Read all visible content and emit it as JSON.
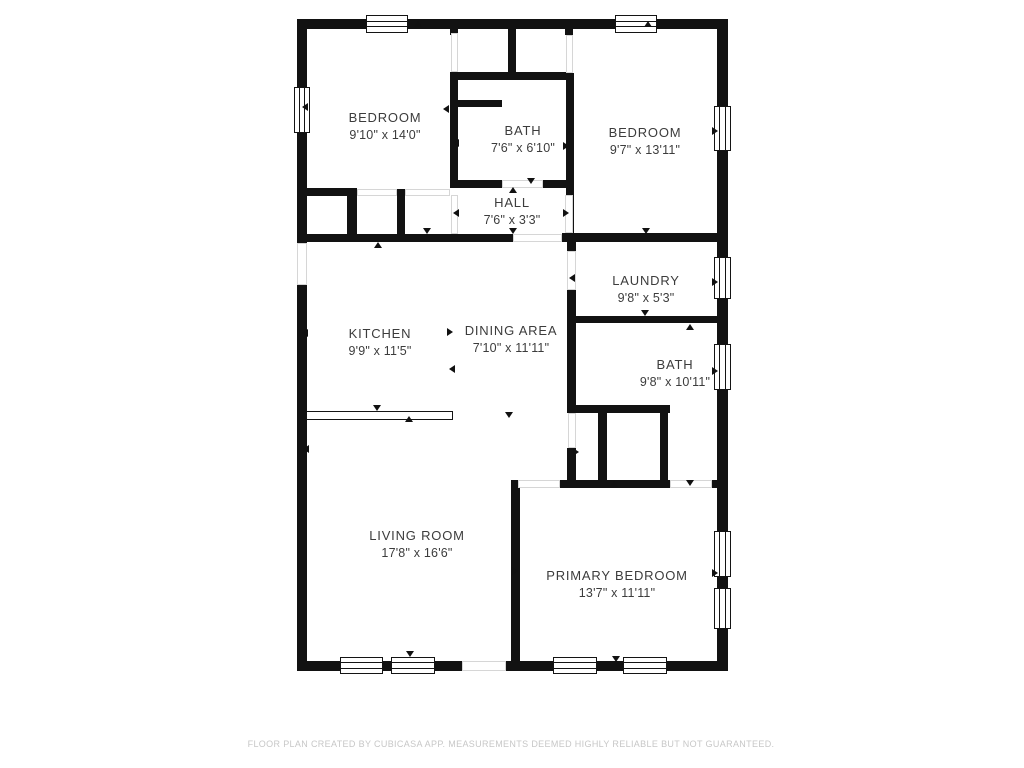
{
  "meta": {
    "type": "floor-plan",
    "background_color": "#ffffff",
    "wall_color": "#121212",
    "label_color": "#3c3c3c",
    "footer_color": "#c7c7c7"
  },
  "rooms": [
    {
      "name": "BEDROOM",
      "dims": "9'10\" x 14'0\"",
      "cx": 385,
      "cy": 126
    },
    {
      "name": "BATH",
      "dims": "7'6\" x 6'10\"",
      "cx": 523,
      "cy": 139
    },
    {
      "name": "BEDROOM",
      "dims": "9'7\" x 13'11\"",
      "cx": 645,
      "cy": 141
    },
    {
      "name": "HALL",
      "dims": "7'6\" x 3'3\"",
      "cx": 512,
      "cy": 211
    },
    {
      "name": "LAUNDRY",
      "dims": "9'8\" x 5'3\"",
      "cx": 646,
      "cy": 289
    },
    {
      "name": "KITCHEN",
      "dims": "9'9\" x 11'5\"",
      "cx": 380,
      "cy": 342
    },
    {
      "name": "DINING AREA",
      "dims": "7'10\" x 11'11\"",
      "cx": 511,
      "cy": 339
    },
    {
      "name": "BATH",
      "dims": "9'8\" x 10'11\"",
      "cx": 675,
      "cy": 373
    },
    {
      "name": "LIVING ROOM",
      "dims": "17'8\" x 16'6\"",
      "cx": 417,
      "cy": 544
    },
    {
      "name": "PRIMARY BEDROOM",
      "dims": "13'7\" x 11'11\"",
      "cx": 617,
      "cy": 584
    }
  ],
  "geometry": {
    "walls": [
      [
        297,
        19,
        431,
        10
      ],
      [
        297,
        19,
        10,
        652
      ],
      [
        717,
        19,
        11,
        652
      ],
      [
        297,
        661,
        431,
        10
      ],
      [
        450,
        28,
        8,
        7
      ],
      [
        508,
        28,
        8,
        44
      ],
      [
        565,
        28,
        8,
        7
      ],
      [
        450,
        72,
        122,
        8
      ],
      [
        450,
        72,
        8,
        115
      ],
      [
        457,
        100,
        45,
        7
      ],
      [
        566,
        73,
        8,
        169
      ],
      [
        450,
        180,
        52,
        8
      ],
      [
        543,
        180,
        29,
        8
      ],
      [
        297,
        188,
        60,
        8
      ],
      [
        347,
        188,
        10,
        52
      ],
      [
        397,
        189,
        8,
        51
      ],
      [
        297,
        234,
        216,
        8
      ],
      [
        562,
        233,
        166,
        9
      ],
      [
        567,
        242,
        9,
        9
      ],
      [
        567,
        290,
        9,
        123
      ],
      [
        567,
        448,
        9,
        34
      ],
      [
        575,
        316,
        153,
        7
      ],
      [
        568,
        405,
        102,
        8
      ],
      [
        598,
        413,
        9,
        67
      ],
      [
        660,
        412,
        8,
        68
      ],
      [
        511,
        480,
        7,
        8
      ],
      [
        560,
        480,
        110,
        8
      ],
      [
        712,
        480,
        8,
        8
      ],
      [
        511,
        480,
        9,
        181
      ]
    ],
    "openings": [
      [
        451,
        33,
        7,
        39
      ],
      [
        566,
        35,
        7,
        38
      ],
      [
        502,
        180,
        41,
        8
      ],
      [
        451,
        195,
        7,
        39
      ],
      [
        565,
        195,
        8,
        38
      ],
      [
        513,
        234,
        49,
        8
      ],
      [
        567,
        251,
        9,
        39
      ],
      [
        568,
        413,
        8,
        35
      ],
      [
        518,
        480,
        42,
        8
      ],
      [
        670,
        480,
        42,
        8
      ],
      [
        462,
        661,
        44,
        10
      ],
      [
        297,
        243,
        10,
        42
      ],
      [
        357,
        189,
        40,
        7
      ],
      [
        405,
        189,
        45,
        7
      ]
    ],
    "windows": [
      [
        366,
        15,
        42,
        18,
        "h"
      ],
      [
        615,
        15,
        42,
        18,
        "h"
      ],
      [
        294,
        87,
        16,
        46,
        "v"
      ],
      [
        714,
        106,
        17,
        45,
        "v"
      ],
      [
        714,
        257,
        17,
        42,
        "v"
      ],
      [
        714,
        344,
        17,
        46,
        "v"
      ],
      [
        714,
        531,
        17,
        46,
        "v"
      ],
      [
        714,
        588,
        17,
        41,
        "v"
      ],
      [
        340,
        657,
        43,
        17,
        "h"
      ],
      [
        391,
        657,
        44,
        17,
        "h"
      ],
      [
        553,
        657,
        44,
        17,
        "h"
      ],
      [
        623,
        657,
        44,
        17,
        "h"
      ]
    ],
    "door_arrows": [
      [
        418,
        24,
        "up"
      ],
      [
        648,
        24,
        "up"
      ],
      [
        306,
        106,
        "left"
      ],
      [
        716,
        130,
        "right"
      ],
      [
        447,
        108,
        "left"
      ],
      [
        457,
        142,
        "left"
      ],
      [
        571,
        130,
        "right"
      ],
      [
        567,
        145,
        "right"
      ],
      [
        531,
        181,
        "down"
      ],
      [
        513,
        190,
        "up"
      ],
      [
        457,
        212,
        "left"
      ],
      [
        567,
        212,
        "right"
      ],
      [
        427,
        231,
        "down"
      ],
      [
        378,
        245,
        "up"
      ],
      [
        513,
        231,
        "down"
      ],
      [
        646,
        231,
        "down"
      ],
      [
        573,
        277,
        "left"
      ],
      [
        716,
        281,
        "right"
      ],
      [
        645,
        313,
        "down"
      ],
      [
        690,
        327,
        "up"
      ],
      [
        306,
        332,
        "left"
      ],
      [
        451,
        331,
        "right"
      ],
      [
        453,
        368,
        "left"
      ],
      [
        716,
        370,
        "right"
      ],
      [
        377,
        408,
        "down"
      ],
      [
        409,
        419,
        "up"
      ],
      [
        509,
        415,
        "down"
      ],
      [
        577,
        451,
        "right"
      ],
      [
        307,
        448,
        "left"
      ],
      [
        410,
        654,
        "down"
      ],
      [
        516,
        570,
        "right"
      ],
      [
        716,
        572,
        "right"
      ],
      [
        690,
        483,
        "down"
      ],
      [
        614,
        484,
        "up"
      ],
      [
        616,
        659,
        "down"
      ]
    ],
    "counter": [
      306,
      411,
      147,
      9
    ]
  },
  "footer": {
    "text": "FLOOR PLAN CREATED BY CUBICASA APP. MEASUREMENTS DEEMED HIGHLY RELIABLE BUT NOT GUARANTEED.",
    "cx": 511,
    "cy": 744
  }
}
